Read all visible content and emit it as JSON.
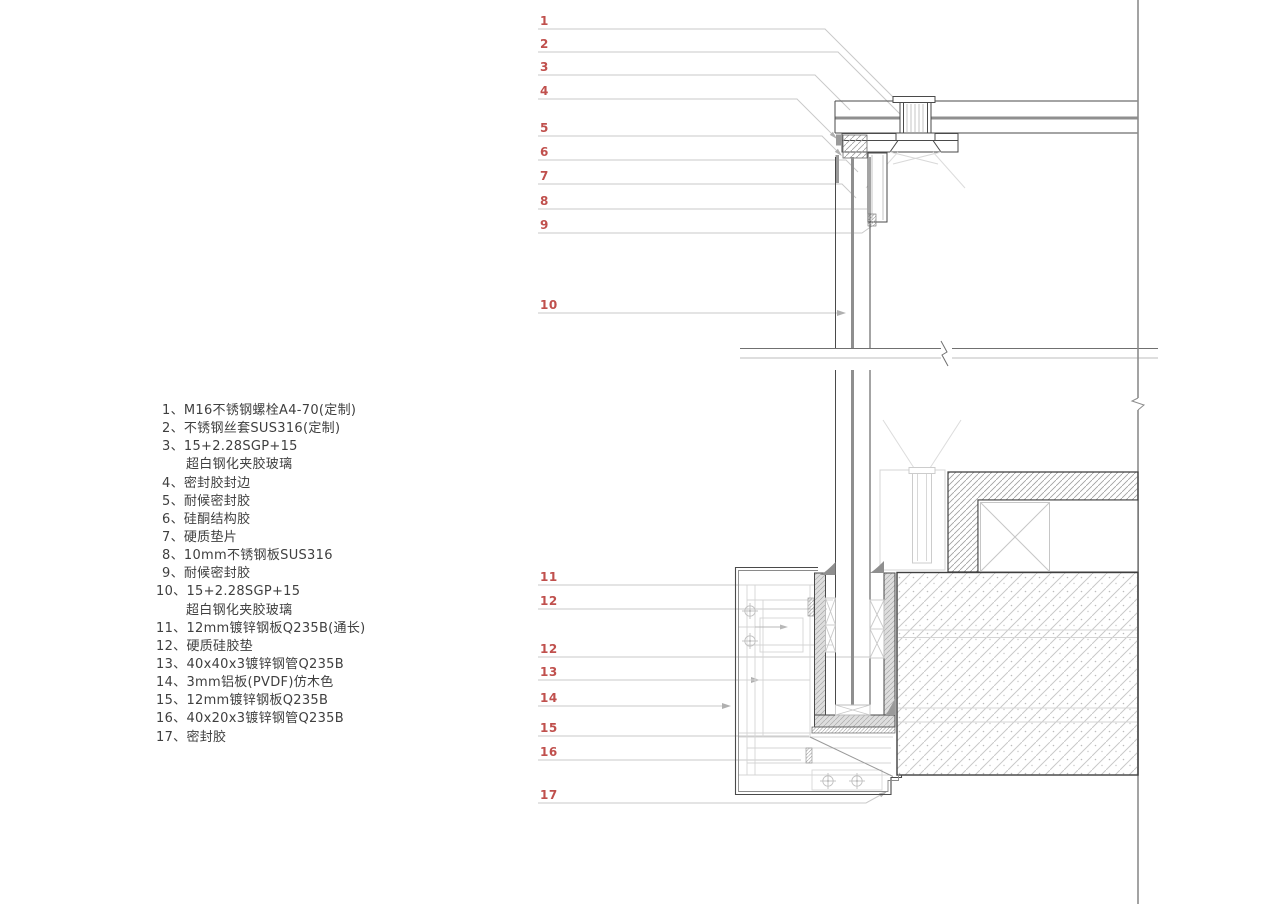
{
  "legend": {
    "items": [
      {
        "label": "1、M16不锈钢螺栓A4-70(定制)"
      },
      {
        "label": "2、不锈钢丝套SUS316(定制)"
      },
      {
        "label": "3、15+2.28SGP+15"
      },
      {
        "label": "超白钢化夹胶玻璃"
      },
      {
        "label": "4、密封胶封边"
      },
      {
        "label": "5、耐候密封胶"
      },
      {
        "label": "6、硅酮结构胶"
      },
      {
        "label": "7、硬质垫片"
      },
      {
        "label": "8、10mm不锈钢板SUS316"
      },
      {
        "label": "9、耐候密封胶"
      },
      {
        "label": "10、15+2.28SGP+15"
      },
      {
        "label": "超白钢化夹胶玻璃"
      },
      {
        "label": "11、12mm镀锌钢板Q235B(通长)"
      },
      {
        "label": "12、硬质硅胶垫"
      },
      {
        "label": "13、40x40x3镀锌钢管Q235B"
      },
      {
        "label": "14、3mm铝板(PVDF)仿木色"
      },
      {
        "label": "15、12mm镀锌钢板Q235B"
      },
      {
        "label": "16、40x20x3镀锌钢管Q235B"
      },
      {
        "label": "17、密封胶"
      }
    ]
  },
  "callouts": {
    "upper": [
      "1",
      "2",
      "3",
      "4",
      "5",
      "6",
      "7",
      "8",
      "9",
      "10"
    ],
    "lower": [
      "11",
      "12",
      "12",
      "13",
      "14",
      "15",
      "16",
      "17"
    ]
  },
  "colors": {
    "callout_red": "#c0504d",
    "line_dark": "#3f3f3f",
    "line_medium": "#707070",
    "line_light": "#c9c9c9",
    "glass_interlayer": "#8f8f8f",
    "shoe_fill": "#dedede",
    "hatch": "#b5b5b5",
    "background": "#ffffff"
  }
}
